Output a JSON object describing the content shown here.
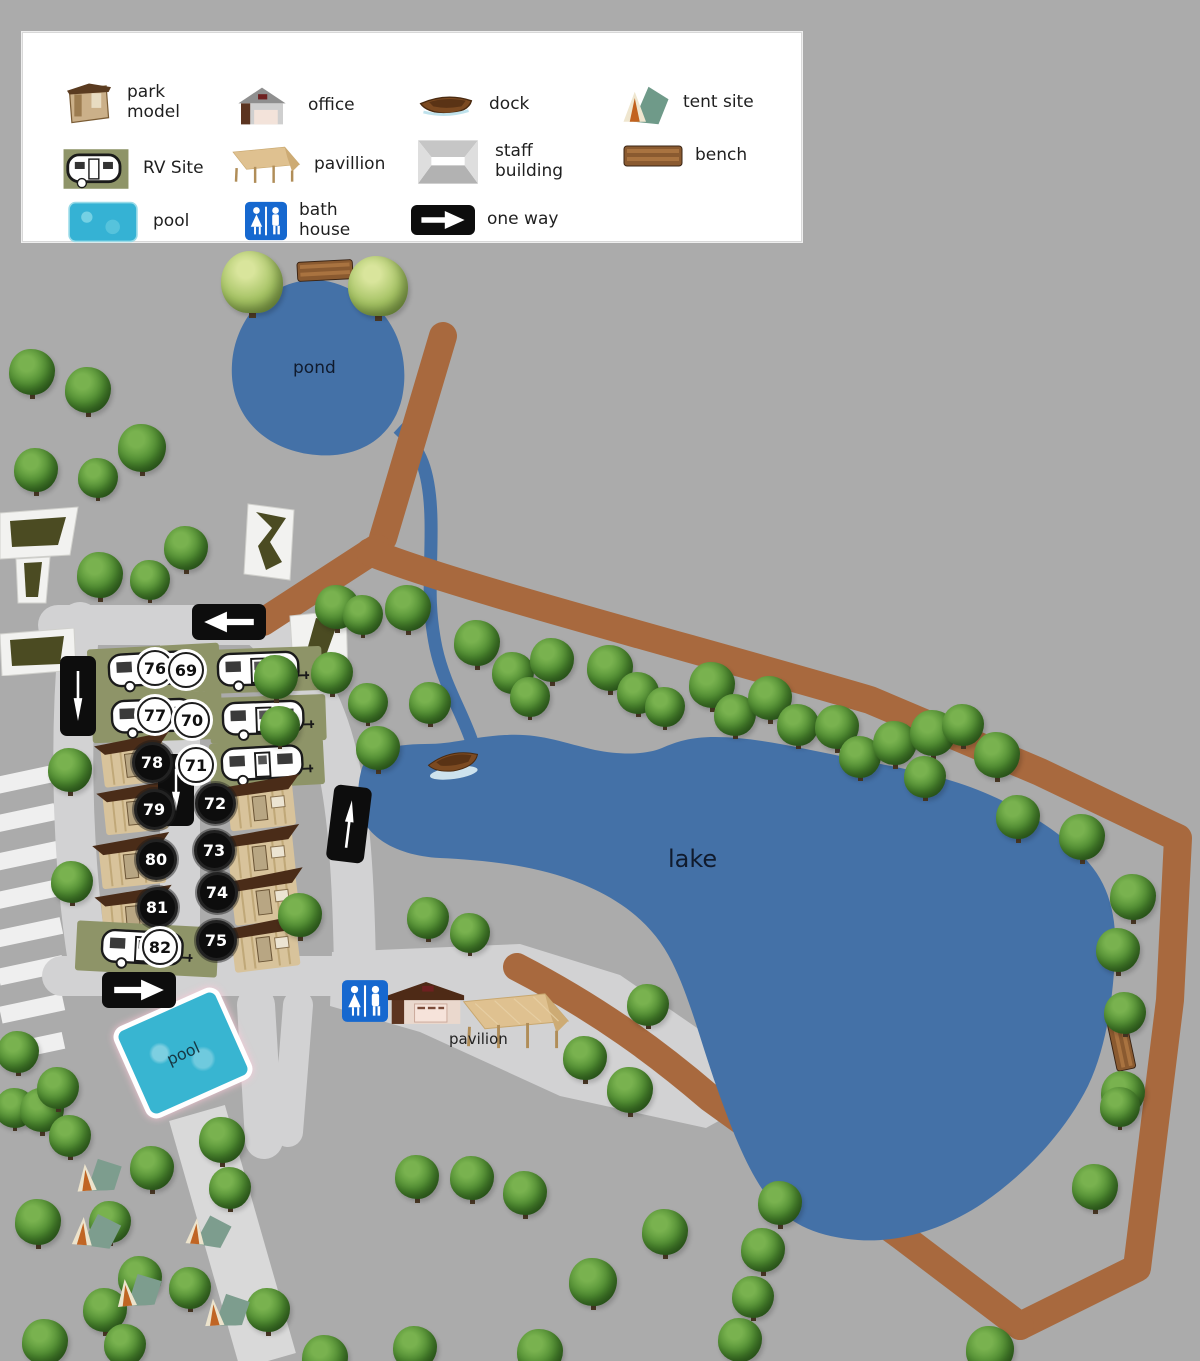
{
  "legend": {
    "items": [
      {
        "label": "park model",
        "icon": "park-model"
      },
      {
        "label": "office",
        "icon": "office"
      },
      {
        "label": "dock",
        "icon": "dock"
      },
      {
        "label": "tent site",
        "icon": "tent-site"
      },
      {
        "label": "RV Site",
        "icon": "rv-site"
      },
      {
        "label": "pavillion",
        "icon": "pavillion"
      },
      {
        "label": "staff building",
        "icon": "staff-building"
      },
      {
        "label": "bench",
        "icon": "bench"
      },
      {
        "label": "pool",
        "icon": "pool"
      },
      {
        "label": "bath house",
        "icon": "bath-house"
      },
      {
        "label": "one way",
        "icon": "one-way"
      }
    ]
  },
  "map_labels": {
    "pond": "pond",
    "lake": "lake",
    "pool": "pool",
    "pavilion": "pavilion"
  },
  "sites": [
    {
      "number": "76",
      "type": "RV Site"
    },
    {
      "number": "77",
      "type": "RV Site"
    },
    {
      "number": "78",
      "type": "park model"
    },
    {
      "number": "79",
      "type": "park model"
    },
    {
      "number": "80",
      "type": "park model"
    },
    {
      "number": "81",
      "type": "park model"
    },
    {
      "number": "82",
      "type": "RV Site"
    },
    {
      "number": "69",
      "type": "RV Site"
    },
    {
      "number": "70",
      "type": "RV Site"
    },
    {
      "number": "71",
      "type": "RV Site"
    },
    {
      "number": "72",
      "type": "park model"
    },
    {
      "number": "73",
      "type": "park model"
    },
    {
      "number": "74",
      "type": "park model"
    },
    {
      "number": "75",
      "type": "park model"
    }
  ],
  "colors": {
    "background": "#ababab",
    "road": "#d2d2d3",
    "trail": "#a8693e",
    "water": "#4471a7",
    "pool": "#38b5d1",
    "rv_pad": "#8e9468",
    "legend_bg": "#ffffff"
  }
}
